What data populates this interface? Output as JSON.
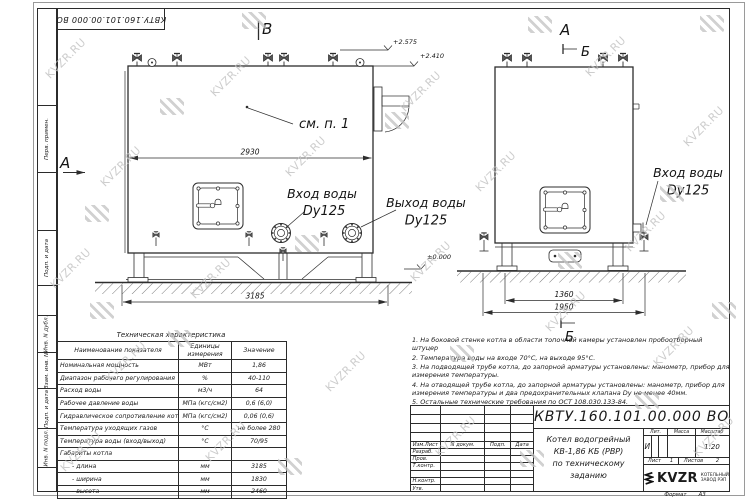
{
  "watermark": {
    "text": "KVZR.RU"
  },
  "frame": {
    "top_stamp": "КВТУ.160.101.00.000 ВО",
    "left_labels": [
      "Перв. примен.",
      "Подп. и дата",
      "Инв. N дубл.",
      "Взам. инв. N",
      "Подп. и дата",
      "Инв. N подл."
    ]
  },
  "drawing": {
    "view_b_top": "В",
    "view_a_left": "А",
    "view_a_title": "А",
    "section_b_top": "Б",
    "section_b_bottom": "Б",
    "see_note": "см. п. 1",
    "inlet_label": "Вход воды",
    "inlet_dn": "Dy125",
    "outlet_label": "Выход воды",
    "outlet_dn": "Dy125",
    "inlet2_label": "Вход воды",
    "inlet2_dn": "Dy125",
    "dim_2930": "2930",
    "dim_3185": "3185",
    "dim_1360": "1360",
    "dim_1950": "1950",
    "elev_high": "+2.575",
    "elev_mid": "+2.410",
    "elev_zero": "±0.000"
  },
  "tech_table": {
    "title": "Техническая характеристика",
    "headers": [
      "Наименование показателя",
      "Единицы измерения",
      "Значение"
    ],
    "rows": [
      {
        "name": "Номинальная мощность",
        "unit": "МВт",
        "value": "1,86"
      },
      {
        "name": "Диапазон рабочего регулирования",
        "unit": "%",
        "value": "40-110"
      },
      {
        "name": "Расход воды",
        "unit": "м3/ч",
        "value": "64"
      },
      {
        "name": "Рабочее давление воды",
        "unit": "МПа (кгс/см2)",
        "value": "0,6 (6,0)"
      },
      {
        "name": "Гидравлическое сопротивление котла",
        "unit": "МПа (кгс/см2)",
        "value": "0,06 (0,6)"
      },
      {
        "name": "Температура уходящих газов",
        "unit": "°С",
        "value": "не более 280"
      },
      {
        "name": "Температура воды (вход/выход)",
        "unit": "°С",
        "value": "70/95"
      },
      {
        "name": "Габариты котла",
        "unit": "",
        "value": ""
      },
      {
        "name": "- длина",
        "unit": "мм",
        "value": "3185"
      },
      {
        "name": "- ширина",
        "unit": "мм",
        "value": "1830"
      },
      {
        "name": "- высота",
        "unit": "мм",
        "value": "2460"
      }
    ]
  },
  "notes": {
    "items": [
      "1.  На боковой стенке котла в области топочной камеры установлен пробоотборный штуцер",
      "2.  Температура воды на входе  70°С,  на выходе  95°С.",
      "3.  На подводящей трубе котла, до запорной арматуры установлены:  манометр,  прибор для измерения температуры.",
      "4.  На отводящей трубе котла, до запорной арматуры установлены:  манометр,  прибор для измерения температуры и два предохранительных клапана  Dу не менее  40мм.",
      "5.  Остальные технические требования по ОСТ  108.030.133-84."
    ]
  },
  "title_block": {
    "doc_number": "КВТУ.160.101.00.000  ВО",
    "title_lines": [
      "Котел водогрейный",
      "КВ-1,86 КБ (РВР)",
      "по техническому заданию"
    ],
    "sig_header": [
      "Изм.Лист",
      "N докум.",
      "Подп.",
      "Дата"
    ],
    "sig_rows": [
      "Разраб.",
      "Пров.",
      "Т.контр.",
      "",
      "Н.контр.",
      "Утв."
    ],
    "lit_header": "Лит.",
    "mass_header": "Масса",
    "scale_header": "Масштаб",
    "lit_value": "И",
    "scale_value": "1:20",
    "sheet_label": "Лист",
    "sheet_value": "1",
    "sheets_label": "Листов",
    "sheets_value": "2",
    "logo_text": "KVZR",
    "logo_sub1": "КОТЕЛЬНЫЙ",
    "logo_sub2": "ЗАВОД РЭП",
    "format_label": "Формат",
    "format_value": "А3"
  }
}
